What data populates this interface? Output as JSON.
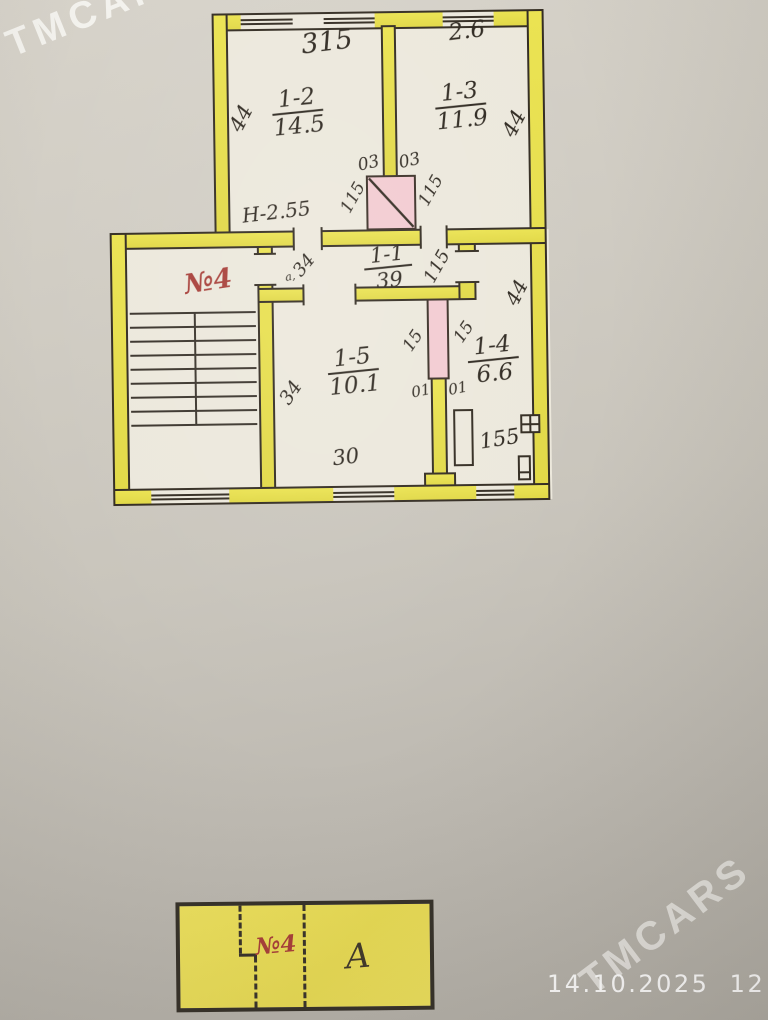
{
  "photo": {
    "watermark_text": "TMCARS",
    "timestamp": "14.10.2025  12:55"
  },
  "plan": {
    "stair_unit_label": "№4",
    "height_note": "Н-2.55",
    "rooms": [
      {
        "number": "1-2",
        "area": "14.5"
      },
      {
        "number": "1-3",
        "area": "11.9"
      },
      {
        "number": "1-1",
        "area": "39"
      },
      {
        "number": "1-5",
        "area": "10.1"
      },
      {
        "number": "1-4",
        "area": "6.6"
      }
    ],
    "dims": [
      "315",
      "2.6",
      "44",
      "44",
      "03",
      "03",
      "115",
      "115",
      "34",
      "а,",
      "115",
      "44",
      "15",
      "15",
      "01",
      "01",
      "34",
      "30",
      "155"
    ]
  },
  "key_plan": {
    "unit_label": "№4",
    "block_label": "А"
  },
  "colors": {
    "wall_yellow": "#e8e04e",
    "shaft_pink": "#f2cbd1",
    "ink": "#332c22",
    "red_label": "#a8403a",
    "paper_bg": "#cbc7be",
    "plan_paper": "#ece8dc"
  }
}
